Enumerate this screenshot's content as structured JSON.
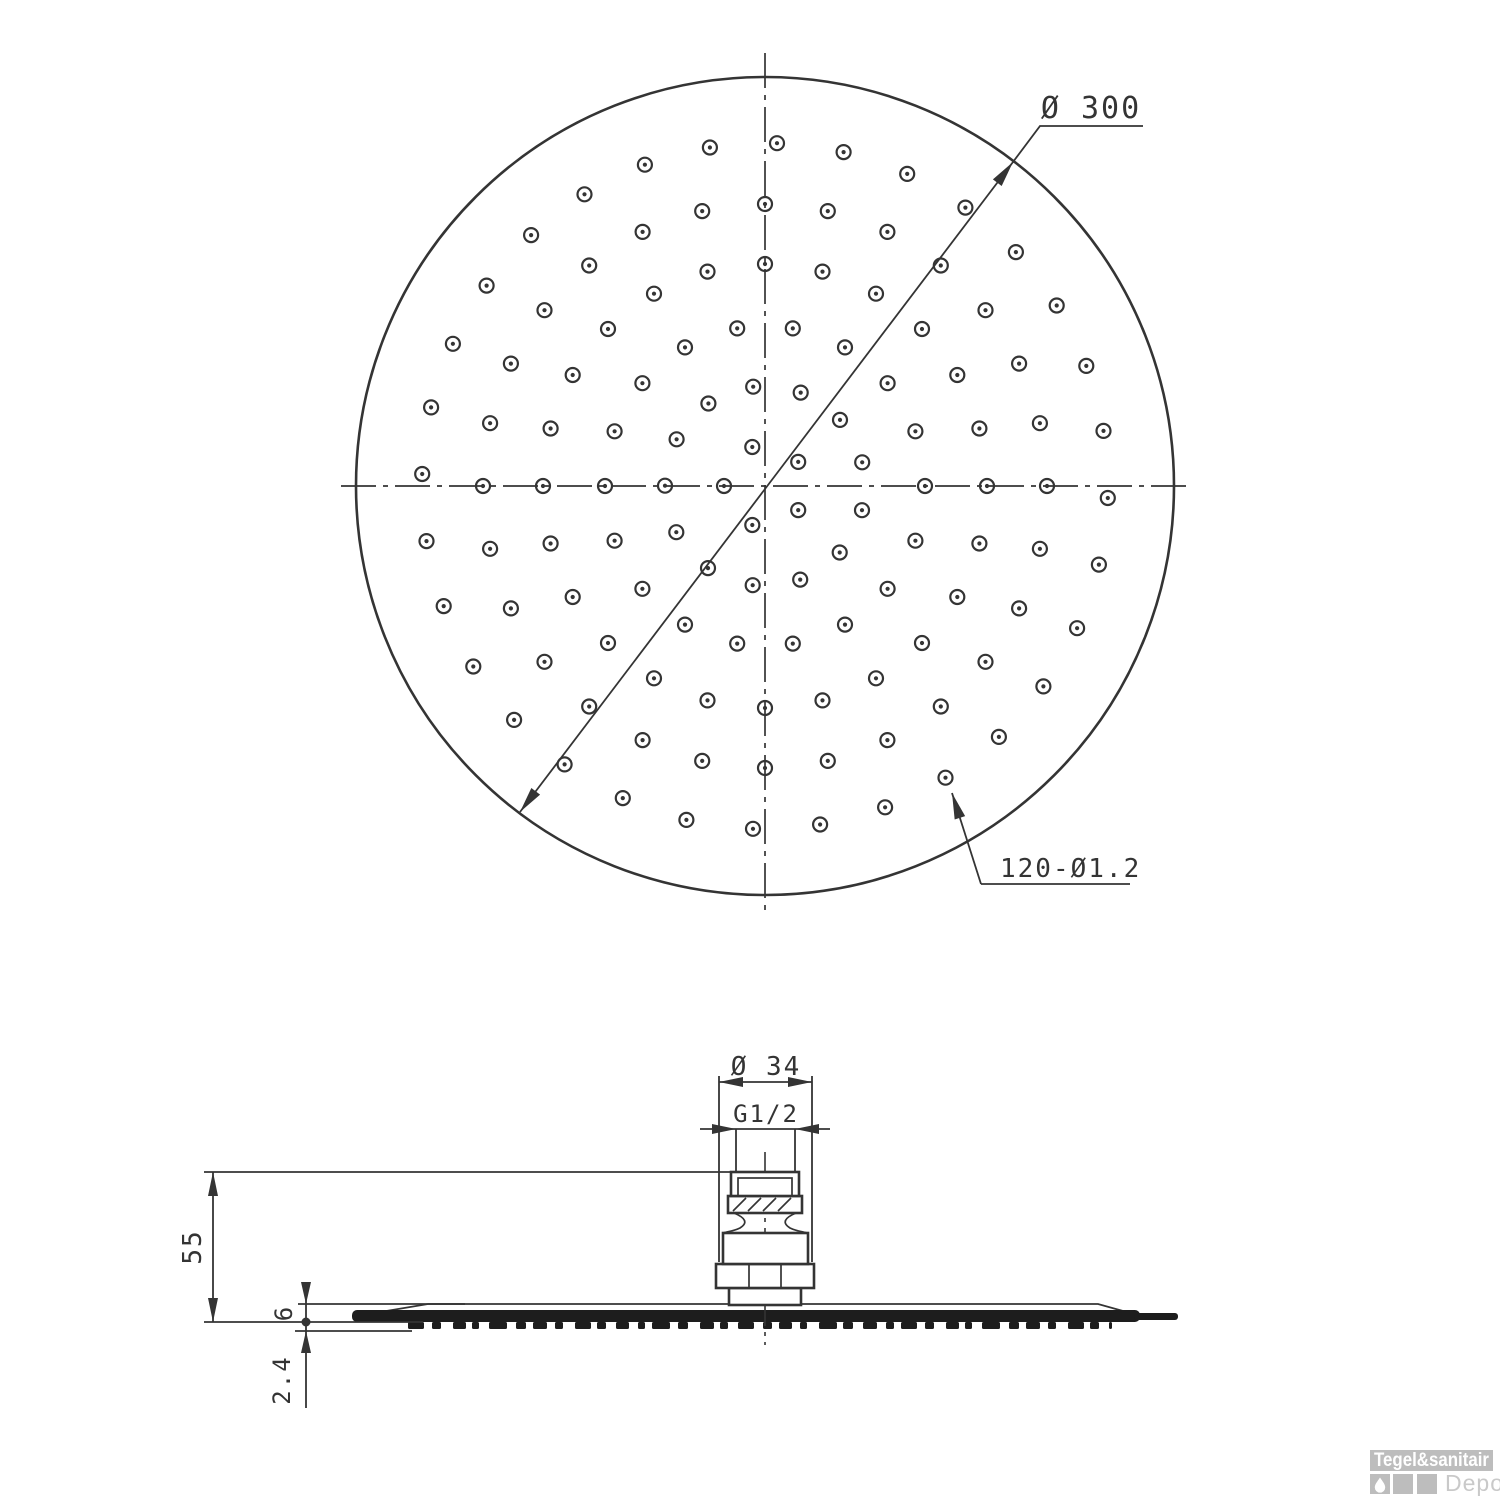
{
  "colors": {
    "line": "#343434",
    "dark_fill": "#1d1d1d",
    "logo_gray": "#bdbdbd",
    "logo_text_light": "#c9c9c9",
    "background": "#ffffff"
  },
  "top_view": {
    "dim_diameter_label": "Ø 300",
    "dim_holes_label": "120-Ø1.2",
    "center_x": 765,
    "center_y": 486,
    "radius": 409,
    "hole_outer_r": 7,
    "hole_inner_r": 2.1,
    "hole_rings": [
      {
        "r": 41,
        "n": 5,
        "offset_deg": 36
      },
      {
        "r": 100,
        "n": 13,
        "offset_deg": 14
      },
      {
        "r": 160,
        "n": 18,
        "offset_deg": 0
      },
      {
        "r": 222,
        "n": 24,
        "offset_deg": 0
      },
      {
        "r": 282,
        "n": 28,
        "offset_deg": 0
      },
      {
        "r": 343,
        "n": 32,
        "offset_deg": 2
      }
    ]
  },
  "side_view": {
    "dim_connector_diameter": "Ø 34",
    "dim_thread": "G1/2",
    "dim_height": "55",
    "dim_plate_thickness": "6",
    "dim_nozzle_height": "2.4",
    "nozzle_teeth": {
      "x_start": 408,
      "x_end": 1112,
      "y": 1322,
      "height": 7,
      "widths": [
        16,
        9,
        13,
        7,
        18,
        10,
        14,
        8
      ],
      "gaps": [
        8,
        12,
        6,
        10,
        9,
        7
      ]
    }
  },
  "watermark": {
    "brand": "Tegel&sanitair",
    "sub_brand": "Depot"
  }
}
